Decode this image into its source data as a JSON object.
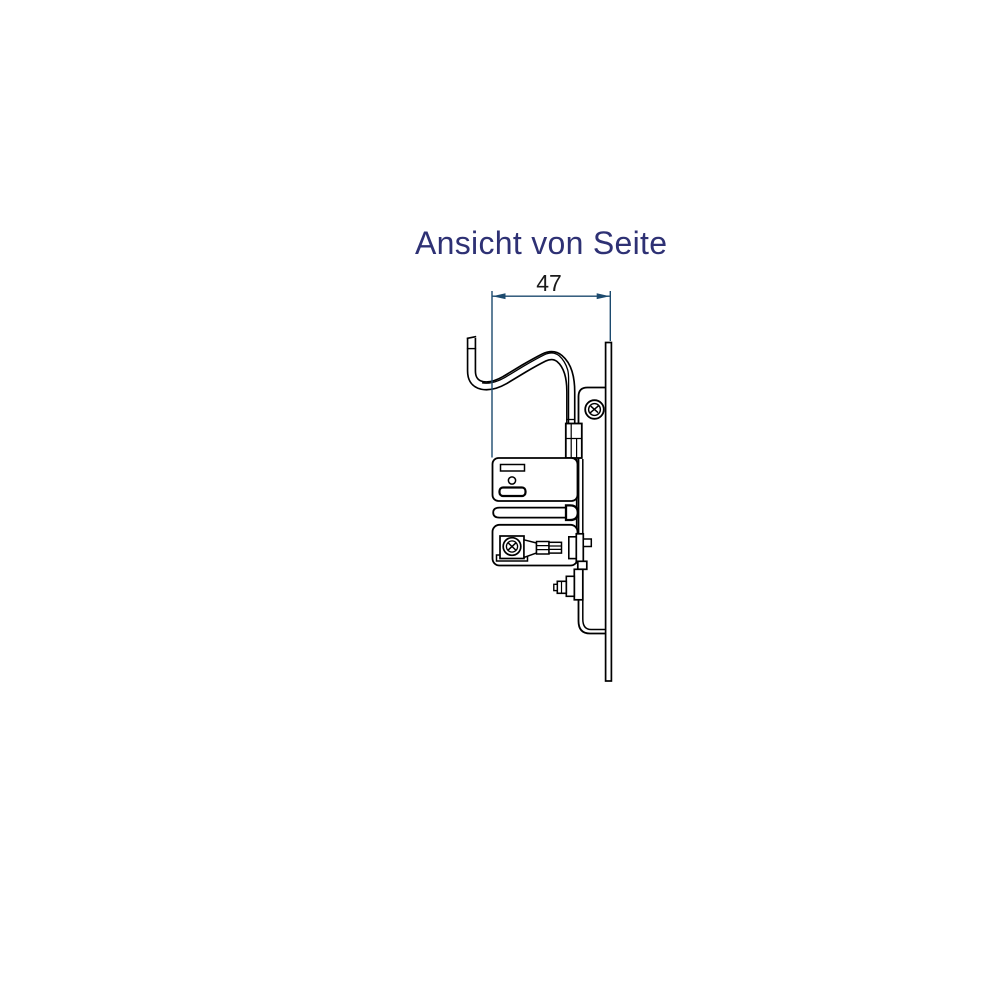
{
  "colors": {
    "title-color": "#2e3174",
    "dim-color": "#1c4a6e",
    "line-color": "#000000",
    "dim-text-color": "#1a1a1a",
    "bg-color": "#ffffff"
  },
  "title": {
    "text": "Ansicht von Seite"
  },
  "dimension": {
    "label": "47"
  }
}
